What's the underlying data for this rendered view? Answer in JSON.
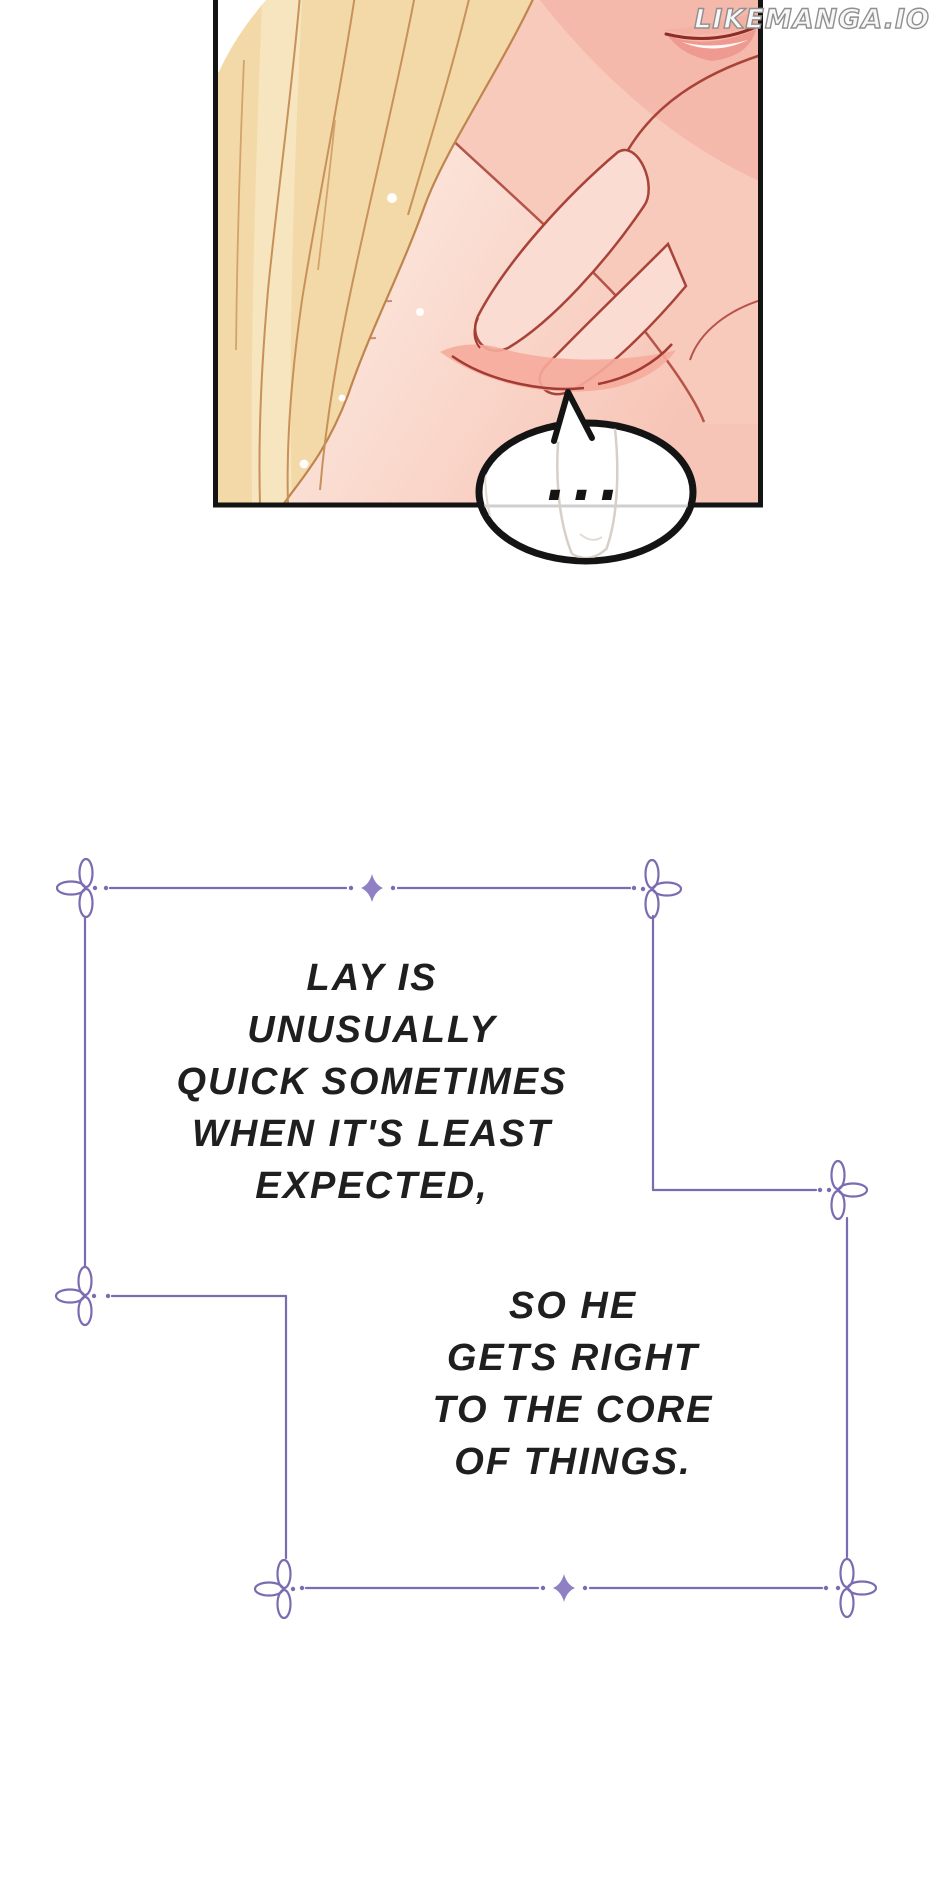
{
  "page": {
    "width": 940,
    "height": 1893,
    "background": "#ffffff"
  },
  "watermark": {
    "text": "LIKEMANGA.IO"
  },
  "panel": {
    "type": "manga-panel",
    "border_color": "#141414",
    "speech_bubble": {
      "text": "...",
      "fill": "#ffffff",
      "outline": "#141414"
    },
    "art_colors": {
      "hair_gold": "#f2d9a7",
      "hair_line": "#c8915a",
      "skin_light": "#fdeee7",
      "skin_pink": "#f8ccbd",
      "skin_deep": "#f5bcae",
      "outline_red": "#a8433a",
      "lip_pink": "#ef9a90"
    }
  },
  "narration": {
    "text_color": "#1f1f1f",
    "frame": {
      "line_color": "#7b6cb1",
      "diamond_color": "#8e80c3",
      "corner_icon": "clover-loop-ornament",
      "divider_icon": "sparkle-diamond"
    },
    "block1": {
      "lines": [
        "LAY IS",
        "UNUSUALLY",
        "QUICK SOMETIMES",
        "WHEN IT'S LEAST",
        "EXPECTED,"
      ]
    },
    "block2": {
      "lines": [
        "SO HE",
        "GETS RIGHT",
        "TO THE CORE",
        "OF THINGS."
      ]
    }
  }
}
